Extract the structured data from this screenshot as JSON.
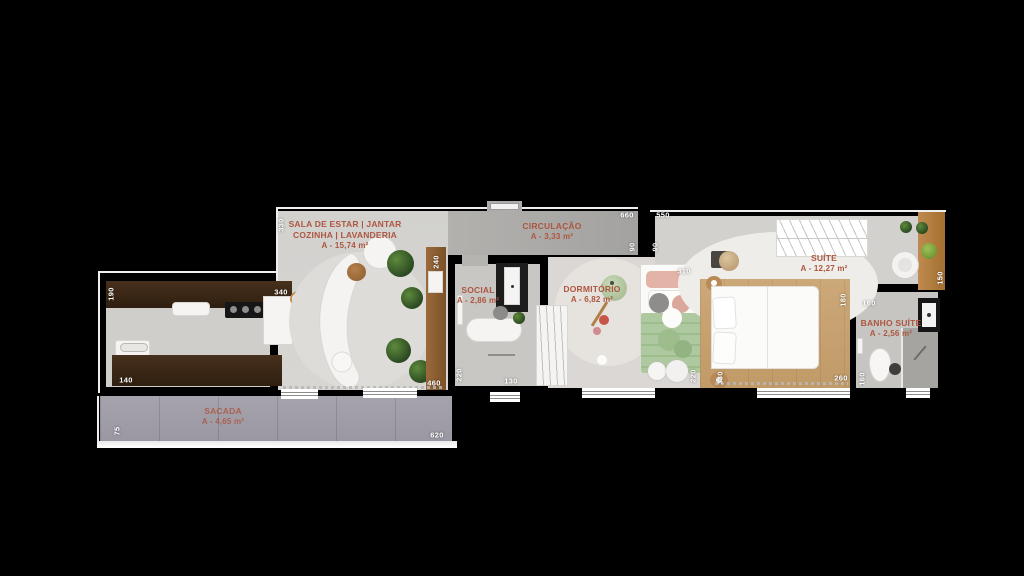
{
  "plan_title": "apartment-floor-plan",
  "colors": {
    "background": "#000000",
    "floor_grey": "#d6d4d1",
    "corridor_grey": "#a9a8a5",
    "balcony_grey": "#9c99a4",
    "counter_wood_dark": "#3a2817",
    "furniture_wood": "#b9854f",
    "bed_platform_wood": "#c9a476",
    "room_label_text": "#ad5640",
    "dimension_text": "#ffffff",
    "plant_green": "#3d5f2e"
  },
  "rooms": {
    "sala": {
      "label": "SALA DE ESTAR | JANTAR",
      "label2": "COZINHA | LAVANDERIA",
      "area": "A - 15,74 m²"
    },
    "circulacao": {
      "label": "CIRCULAÇÃO",
      "area": "A - 3,33 m²"
    },
    "social": {
      "label": "SOCIAL",
      "area": "A - 2,86 m²"
    },
    "dormitorio": {
      "label": "DORMITÓRIO",
      "area": "A - 6,82 m²"
    },
    "suite": {
      "label": "SUÍTE",
      "area": "A - 12,27 m²"
    },
    "banho_suite": {
      "label": "BANHO SUÍTE",
      "area": "A - 2,56 m²"
    },
    "sacada": {
      "label": "SACADA",
      "area": "A - 4,65 m²"
    }
  },
  "dims": [
    {
      "v": "330"
    },
    {
      "v": "660"
    },
    {
      "v": "550"
    },
    {
      "v": "90"
    },
    {
      "v": "90"
    },
    {
      "v": "240"
    },
    {
      "v": "310"
    },
    {
      "v": "190"
    },
    {
      "v": "340"
    },
    {
      "v": "140"
    },
    {
      "v": "460"
    },
    {
      "v": "220"
    },
    {
      "v": "130"
    },
    {
      "v": "220"
    },
    {
      "v": "330"
    },
    {
      "v": "180"
    },
    {
      "v": "260"
    },
    {
      "v": "150"
    },
    {
      "v": "160"
    },
    {
      "v": "160"
    },
    {
      "v": "75"
    },
    {
      "v": "620"
    }
  ]
}
